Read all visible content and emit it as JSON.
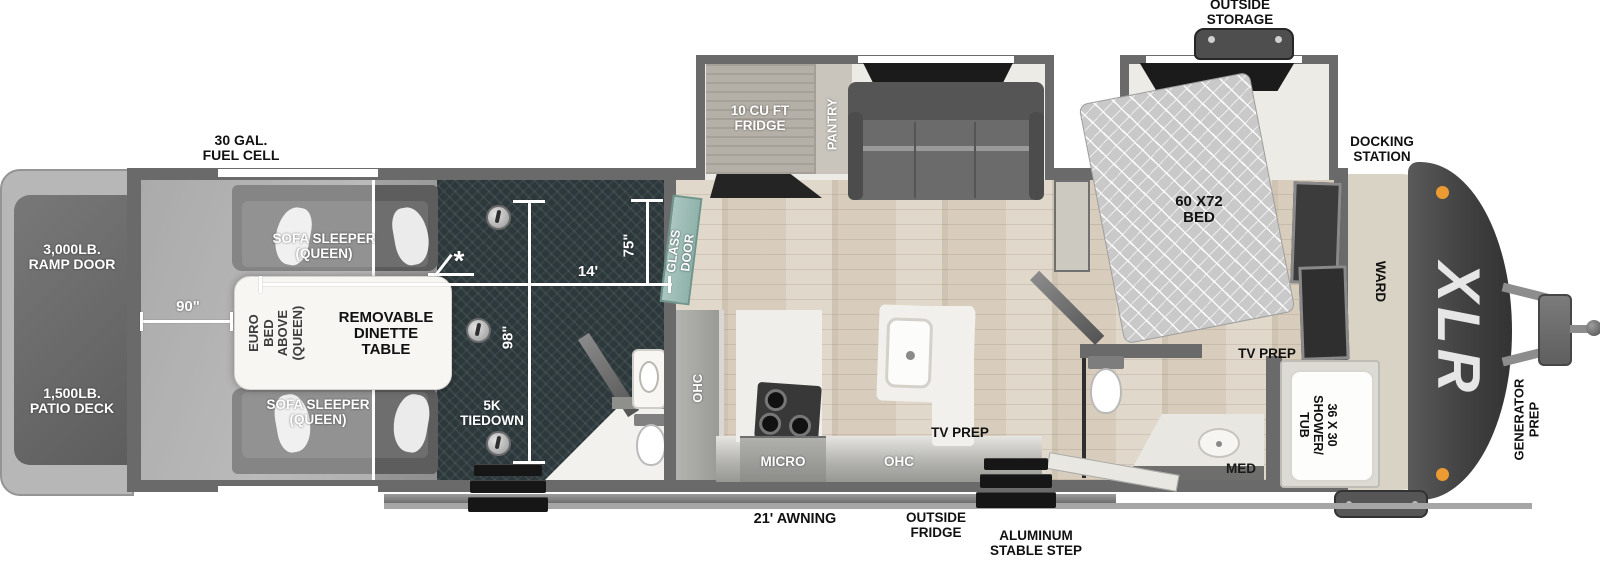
{
  "plan": {
    "rear_exterior": {
      "fuel_cell": "30 GAL.\nFUEL CELL",
      "ramp_door": "3,000LB.\nRAMP DOOR",
      "patio_deck": "1,500LB.\nPATIO DECK"
    },
    "garage": {
      "sofa_top": "SOFA SLEEPER\n(QUEEN)",
      "sofa_bottom": "SOFA SLEEPER\n(QUEEN)",
      "euro_bed": "EURO BED\nABOVE\n(QUEEN)",
      "dinette_table": "REMOVABLE\nDINETTE\nTABLE",
      "tiedown": "5K\nTIEDOWN",
      "note_marker": "*",
      "dim_rear_width": "90\"",
      "dim_length": "14'",
      "dim_width": "98\"",
      "dim_door_width": "75\"",
      "glass_door": "GLASS\nDOOR"
    },
    "kitchen": {
      "fridge": "10 CU FT\nFRIDGE",
      "pantry": "PANTRY",
      "ohc_wall": "OHC",
      "ohc_lower": "OHC",
      "micro": "MICRO",
      "tv_prep": "TV PREP"
    },
    "bedroom": {
      "bed": "60 X72\nBED",
      "outside_storage": "OUTSIDE\nSTORAGE",
      "docking_station": "DOCKING\nSTATION",
      "ward": "WARD",
      "tv_prep": "TV PREP"
    },
    "bathroom": {
      "shower": "36 X 30\nSHOWER/\nTUB",
      "med": "MED"
    },
    "front_exterior": {
      "generator_prep": "GENERATOR\nPREP",
      "logo": "XLR"
    },
    "door_side": {
      "awning": "21' AWNING",
      "outside_fridge": "OUTSIDE\nFRIDGE",
      "stable_step": "ALUMINUM\nSTABLE STEP"
    }
  }
}
